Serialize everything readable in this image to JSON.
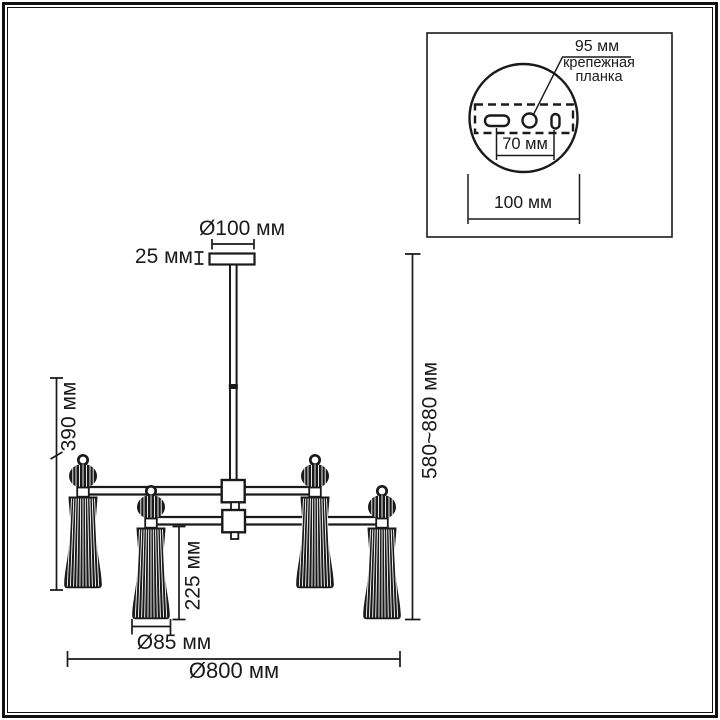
{
  "diagram": {
    "background": "#ffffff",
    "ink_color": "#1a1a1a",
    "dimensions": {
      "canopy_diameter": "Ø100 мм",
      "canopy_height": "25 мм",
      "body_height": "390 мм",
      "shade_height": "225 мм",
      "shade_diameter": "Ø85 мм",
      "overall_diameter": "Ø800 мм",
      "height_range": "580~880 мм"
    },
    "inset": {
      "plate_width": "95 мм",
      "plate_label_line1": "крепежная",
      "plate_label_line2": "планка",
      "slot_spacing": "70 мм",
      "circle_diameter": "100 мм"
    }
  }
}
